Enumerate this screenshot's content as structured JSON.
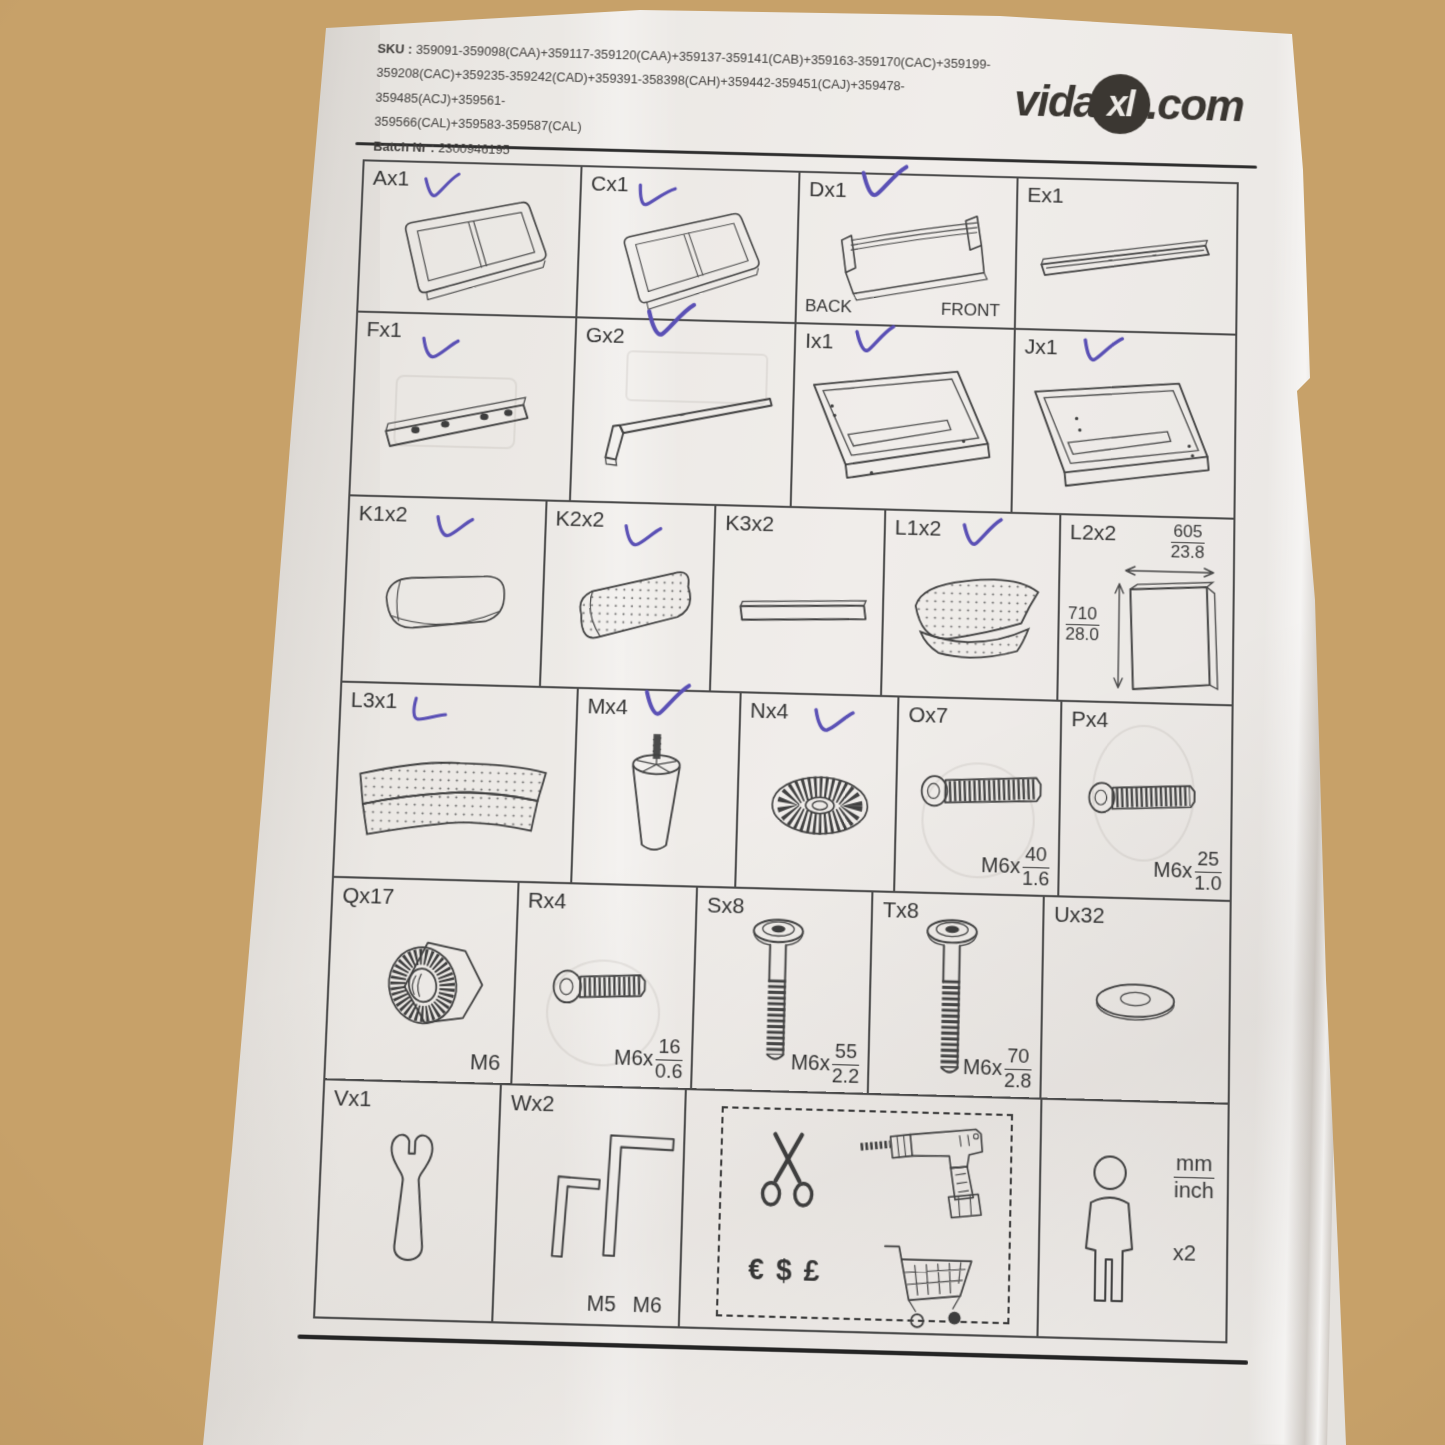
{
  "header": {
    "sku_label": "SKU :",
    "sku_line1": "359091-359098(CAA)+359117-359120(CAA)+359137-359141(CAB)+359163-359170(CAC)+359199-",
    "sku_line2": "359208(CAC)+359235-359242(CAD)+359391-358398(CAH)+359442-359451(CAJ)+359478-359485(ACJ)+359561-",
    "sku_line3": "359566(CAL)+359583-359587(CAL)",
    "batch_label": "Batch Nr :",
    "batch_value": "2300946195",
    "logo_vida": "vida",
    "logo_xl": "xl",
    "logo_com": ".com"
  },
  "parts": {
    "a": {
      "label": "Ax1",
      "checked": true
    },
    "c": {
      "label": "Cx1",
      "checked": true
    },
    "d": {
      "label": "Dx1",
      "checked": true,
      "back_label": "BACK",
      "front_label": "FRONT"
    },
    "e": {
      "label": "Ex1",
      "checked": false
    },
    "f": {
      "label": "Fx1",
      "checked": true
    },
    "g": {
      "label": "Gx2",
      "checked": true
    },
    "i": {
      "label": "Ix1",
      "checked": true
    },
    "j": {
      "label": "Jx1",
      "checked": true
    },
    "k1": {
      "label": "K1x2",
      "checked": true
    },
    "k2": {
      "label": "K2x2",
      "checked": true
    },
    "k3": {
      "label": "K3x2",
      "checked": false
    },
    "l1": {
      "label": "L1x2",
      "checked": true
    },
    "l2": {
      "label": "L2x2",
      "checked": false,
      "width_mm": "605",
      "width_inch": "23.8",
      "height_mm": "710",
      "height_inch": "28.0"
    },
    "l3": {
      "label": "L3x1",
      "checked": true
    },
    "m": {
      "label": "Mx4",
      "checked": true
    },
    "n": {
      "label": "Nx4",
      "checked": true
    },
    "o": {
      "label": "Ox7",
      "checked": false,
      "spec_prefix": "M6x",
      "spec_mm": "40",
      "spec_inch": "1.6"
    },
    "p": {
      "label": "Px4",
      "checked": false,
      "spec_prefix": "M6x",
      "spec_mm": "25",
      "spec_inch": "1.0"
    },
    "q": {
      "label": "Qx17",
      "checked": false,
      "spec": "M6"
    },
    "r": {
      "label": "Rx4",
      "checked": false,
      "spec_prefix": "M6x",
      "spec_mm": "16",
      "spec_inch": "0.6"
    },
    "s": {
      "label": "Sx8",
      "checked": false,
      "spec_prefix": "M6x",
      "spec_mm": "55",
      "spec_inch": "2.2"
    },
    "t": {
      "label": "Tx8",
      "checked": false,
      "spec_prefix": "M6x",
      "spec_mm": "70",
      "spec_inch": "2.8"
    },
    "u": {
      "label": "Ux32",
      "checked": false
    },
    "v": {
      "label": "Vx1",
      "checked": false
    },
    "w": {
      "label": "Wx2",
      "checked": false,
      "key_small_label": "M5",
      "key_large_label": "M6"
    }
  },
  "tools_box": {
    "currency_text": "€ $ £"
  },
  "scale_note": {
    "unit_top": "mm",
    "unit_bottom": "inch",
    "multiplier": "x2"
  },
  "footer": {
    "version": "- V1.0 -   2423"
  }
}
